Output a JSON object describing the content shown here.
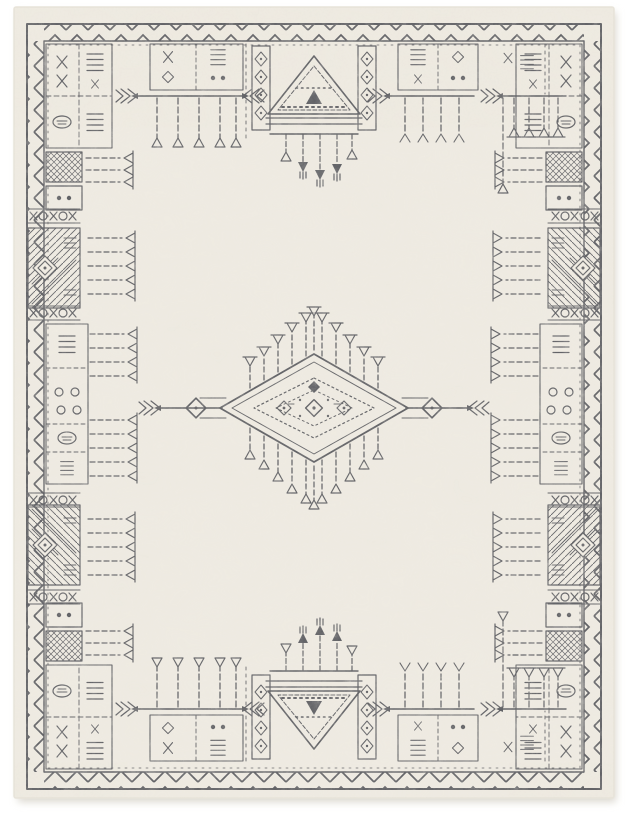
{
  "page": {
    "background_color": "#ffffff"
  },
  "product_photo": {
    "subject": "moroccan-tribal-area-rug",
    "orientation": "portrait",
    "colors": {
      "field": "#f0ece3",
      "ink": "#55565b",
      "shadow": "#dcd8cf",
      "page_bg": "#ffffff",
      "rug_edge": "#e8e4da"
    },
    "design": {
      "border": "double outline frame with chevron zigzag band on all four sides",
      "corner_motifs": "boxed panels of X glyphs, comb glyphs, scroll ovals and crosshatch cells",
      "side_motifs": "diagonal-hatched blocks with diamond, XOXO bands, comb fringes pointing into the field",
      "top_motifs": "horizontal rake lines with fletched arrow ends and hanging fringe teeth under glyph boxes",
      "bottom_motifs": "mirrored rakes with fringe teeth rising and glyph boxes below",
      "center_medallion": "concentric diamond medallion with radiating goblet-tipped fringe and arrow axes ending in small diamonds",
      "top_center_panel": "triangle motif between two ornate pillars with tassels hanging below",
      "bottom_center_panel": "inverted chevron between pillars with candelabra tassels above",
      "finish": "distressed faded charcoal linework on ivory ground"
    }
  }
}
